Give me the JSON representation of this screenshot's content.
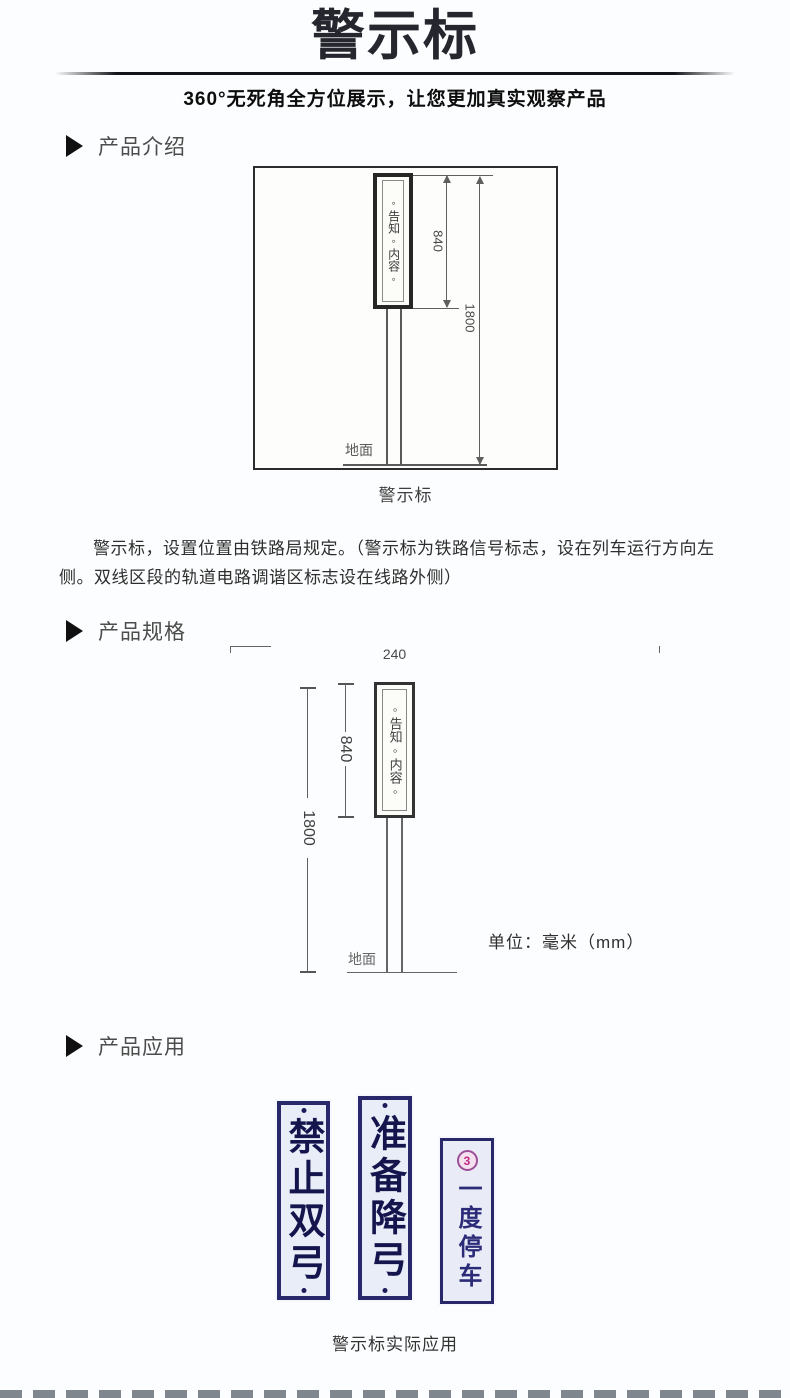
{
  "header": {
    "title": "警示标",
    "subtitle": "360°无死角全方位展示，让您更加真实观察产品"
  },
  "sections": {
    "intro_label": "产品介绍",
    "spec_label": "产品规格",
    "apply_label": "产品应用"
  },
  "intro": {
    "diagram": {
      "sign_text": "◦告知◦内容◦",
      "dim_sign_height": "840",
      "dim_total_height": "1800",
      "ground_label": "地面"
    },
    "caption": "警示标",
    "paragraph": "警示标，设置位置由铁路局规定。（警示标为铁路信号标志，设在列车运行方向左侧。双线区段的轨道电路调谐区标志设在线路外侧）"
  },
  "spec": {
    "diagram": {
      "sign_text": "◦告知◦内容◦",
      "dim_width": "240",
      "dim_sign_height": "840",
      "dim_total_height": "1800",
      "ground_label": "地面",
      "unit_note": "单位：毫米（mm）"
    }
  },
  "application": {
    "signs": [
      {
        "text": "禁止双弓"
      },
      {
        "text": "准备降弓"
      },
      {
        "badge": "3",
        "text": "一度停车"
      }
    ],
    "caption": "警示标实际应用"
  },
  "colors": {
    "title_ink": "#26262f",
    "sign_border_navy": "#28286b",
    "sign_text_navy": "#15154e",
    "badge_purple": "#9c4f96",
    "drawing_line": "#5f5f5f"
  }
}
